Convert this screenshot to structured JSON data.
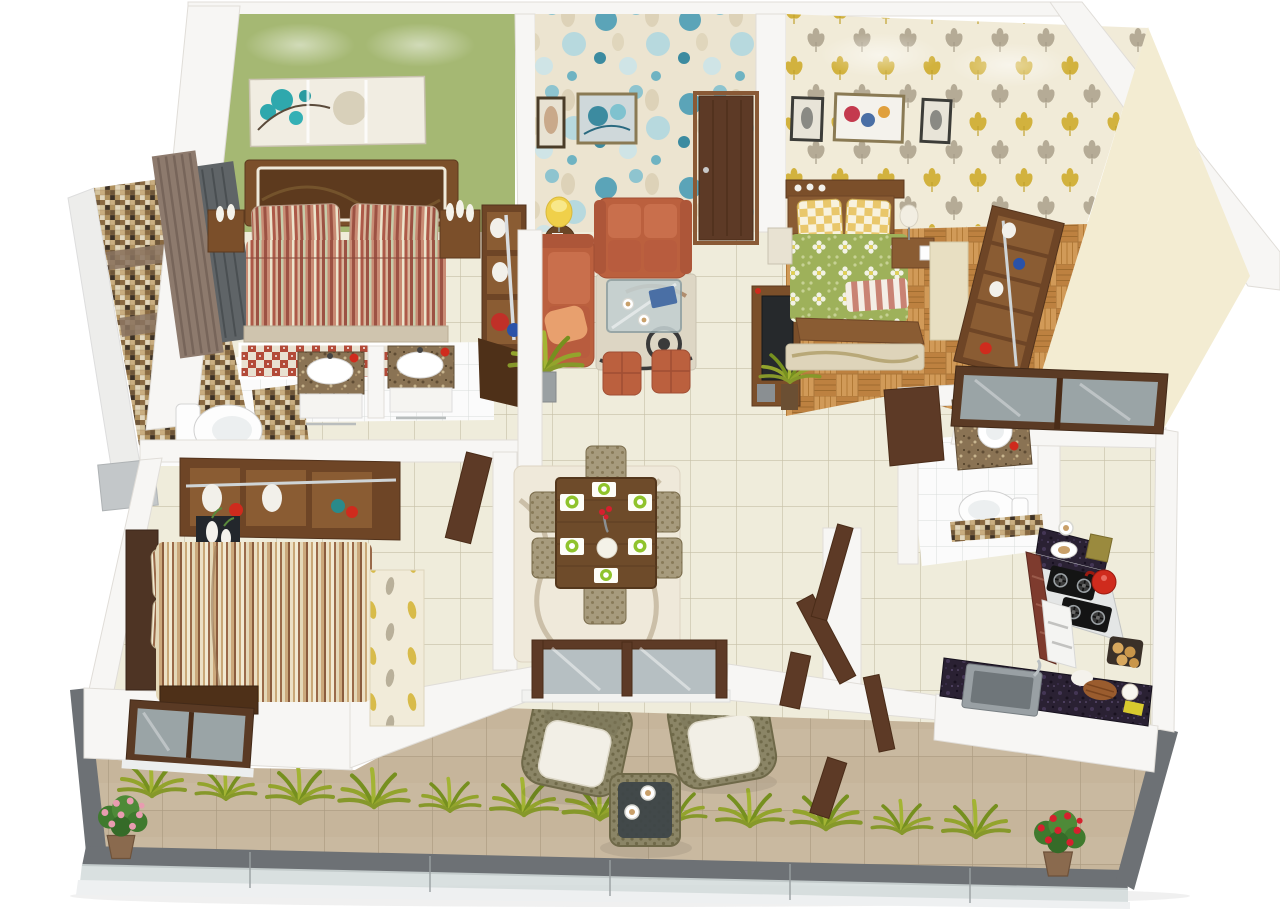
{
  "scene": {
    "description": "Isometric 3D architectural render of a two-bedroom apartment floor plan with wraparound balcony",
    "background": "#ffffff",
    "text_visible": false
  },
  "palette": {
    "background": "#ffffff",
    "wall_white": "#f7f6f4",
    "wall_edge": "#e0ddd8",
    "wall_shade": "#eae8e4",
    "floor_cream": "#efecdb",
    "accent_green": "#a5b873",
    "wallpaper_living": "#ece4d0",
    "circle_teal": "#5ba4b8",
    "wallpaper_leaf_base": "#f1ebd8",
    "leaf_yellow": "#d2b23e",
    "leaf_grey": "#b5ab96",
    "wall_beige": "#f3ecd2",
    "mosaic_tan": "#b0915e",
    "sofa_rust": "#bb603e",
    "cushion_peach": "#e8a06e",
    "wood_dark": "#5d3a26",
    "wood_mid": "#7b4f2a",
    "wood_warm": "#8a5c33",
    "parquet_wood": "#c9904f",
    "bedding_green": "#9eb15a",
    "pillow_yellow": "#e9c76b",
    "throw_pink": "#c98374",
    "granite_dark": "#2a2133",
    "granite_brown": "#8a7354",
    "kettle_red": "#cf2b1d",
    "cabinet_maroon": "#7e3b2e",
    "tile_white": "#fbfbfb",
    "balcony_tile": "#c9b9a0",
    "railing_grey": "#6d7175",
    "glass_grey": "#9aa4a6",
    "glass_pale": "#d2dadb",
    "plant_green": "#93a42c",
    "plant_dark": "#76901f",
    "foliage_green": "#3f7a2e",
    "flower_pink": "#e89cb0",
    "flower_red": "#d6202e",
    "lamp_yellow": "#f0d04a",
    "art_teal": "#2fa8ad",
    "rug_red": "#b34a38",
    "rug_beige": "#ddd6c4",
    "swirl_dark": "#3a3a3a",
    "wicker": "#8b8566",
    "cushion_white": "#f2efe6"
  },
  "rooms": [
    {
      "id": "master-bedroom",
      "name": "master bedroom",
      "wall_finish": "sage green accent wall",
      "items": [
        "teal blossom canvas art",
        "wide wooden headboard bed",
        "rust striped bedding",
        "striped pillows",
        "red patterned rug",
        "bedside tables with white vases",
        "open shelf unit with towels and mop buckets",
        "curtained window"
      ]
    },
    {
      "id": "master-bathroom",
      "name": "master bathroom",
      "wall_finish": "brown mosaic feature wall",
      "items": [
        "wall-hung toilet",
        "twin granite vanities with oval basins",
        "red tumblers",
        "white tile floor",
        "grey utility block"
      ]
    },
    {
      "id": "living-room",
      "name": "living room",
      "wall_finish": "blue circle wallpaper",
      "items": [
        "walnut entry door",
        "two framed artworks",
        "rust loveseat",
        "rust sofa with peach cushion",
        "glass coffee table",
        "swirl rug",
        "two rust ottomans",
        "floor lamp with side table",
        "tv unit",
        "potted plants"
      ]
    },
    {
      "id": "bedroom-2",
      "name": "bedroom two",
      "wall_finish": "yellow and grey leaf wallpaper",
      "items": [
        "three framed artworks",
        "bed with green floral bedding",
        "yellow checkered pillows",
        "pink striped throw",
        "parquet wood floor",
        "striped rug",
        "nightstand",
        "dresser with table lamp",
        "open wardrobe shelf unit",
        "wide walnut window"
      ]
    },
    {
      "id": "bathroom-2",
      "name": "bathroom two",
      "wall_finish": "white with mosaic accent band",
      "items": [
        "granite vanity with round basin",
        "toilet",
        "white tile floor",
        "open walnut door"
      ]
    },
    {
      "id": "bedroom-3",
      "name": "bedroom three",
      "wall_finish": "white",
      "items": [
        "open wardrobe with clothes and chrome rail",
        "planter box with white vases",
        "bed with cream striped bedding",
        "leaf pattern runner rug",
        "dark foot bench",
        "walnut window to balcony"
      ]
    },
    {
      "id": "dining-area",
      "name": "dining area",
      "items": [
        "wooden six-seat dining table",
        "six patterned chairs",
        "green place settings",
        "flower vase",
        "serving bowl",
        "swirl rug",
        "walnut framed sliding door to balcony"
      ]
    },
    {
      "id": "kitchen",
      "name": "kitchen",
      "items": [
        "L-shaped black granite counter",
        "two gas hobs",
        "red kettle",
        "brass canisters",
        "coffee cup and plate",
        "maroon cabinets",
        "white drawer unit",
        "square steel sink",
        "muffin tray",
        "bread roll and coconut",
        "yellow sponge"
      ]
    },
    {
      "id": "balcony",
      "name": "balcony",
      "items": [
        "tan tile deck",
        "grey rail with glass balustrade",
        "fern planting strip",
        "pink flower pot",
        "red flower pot",
        "two wicker armchairs with white cushions",
        "wicker coffee table with two cups",
        "open walnut door leaves"
      ]
    }
  ]
}
